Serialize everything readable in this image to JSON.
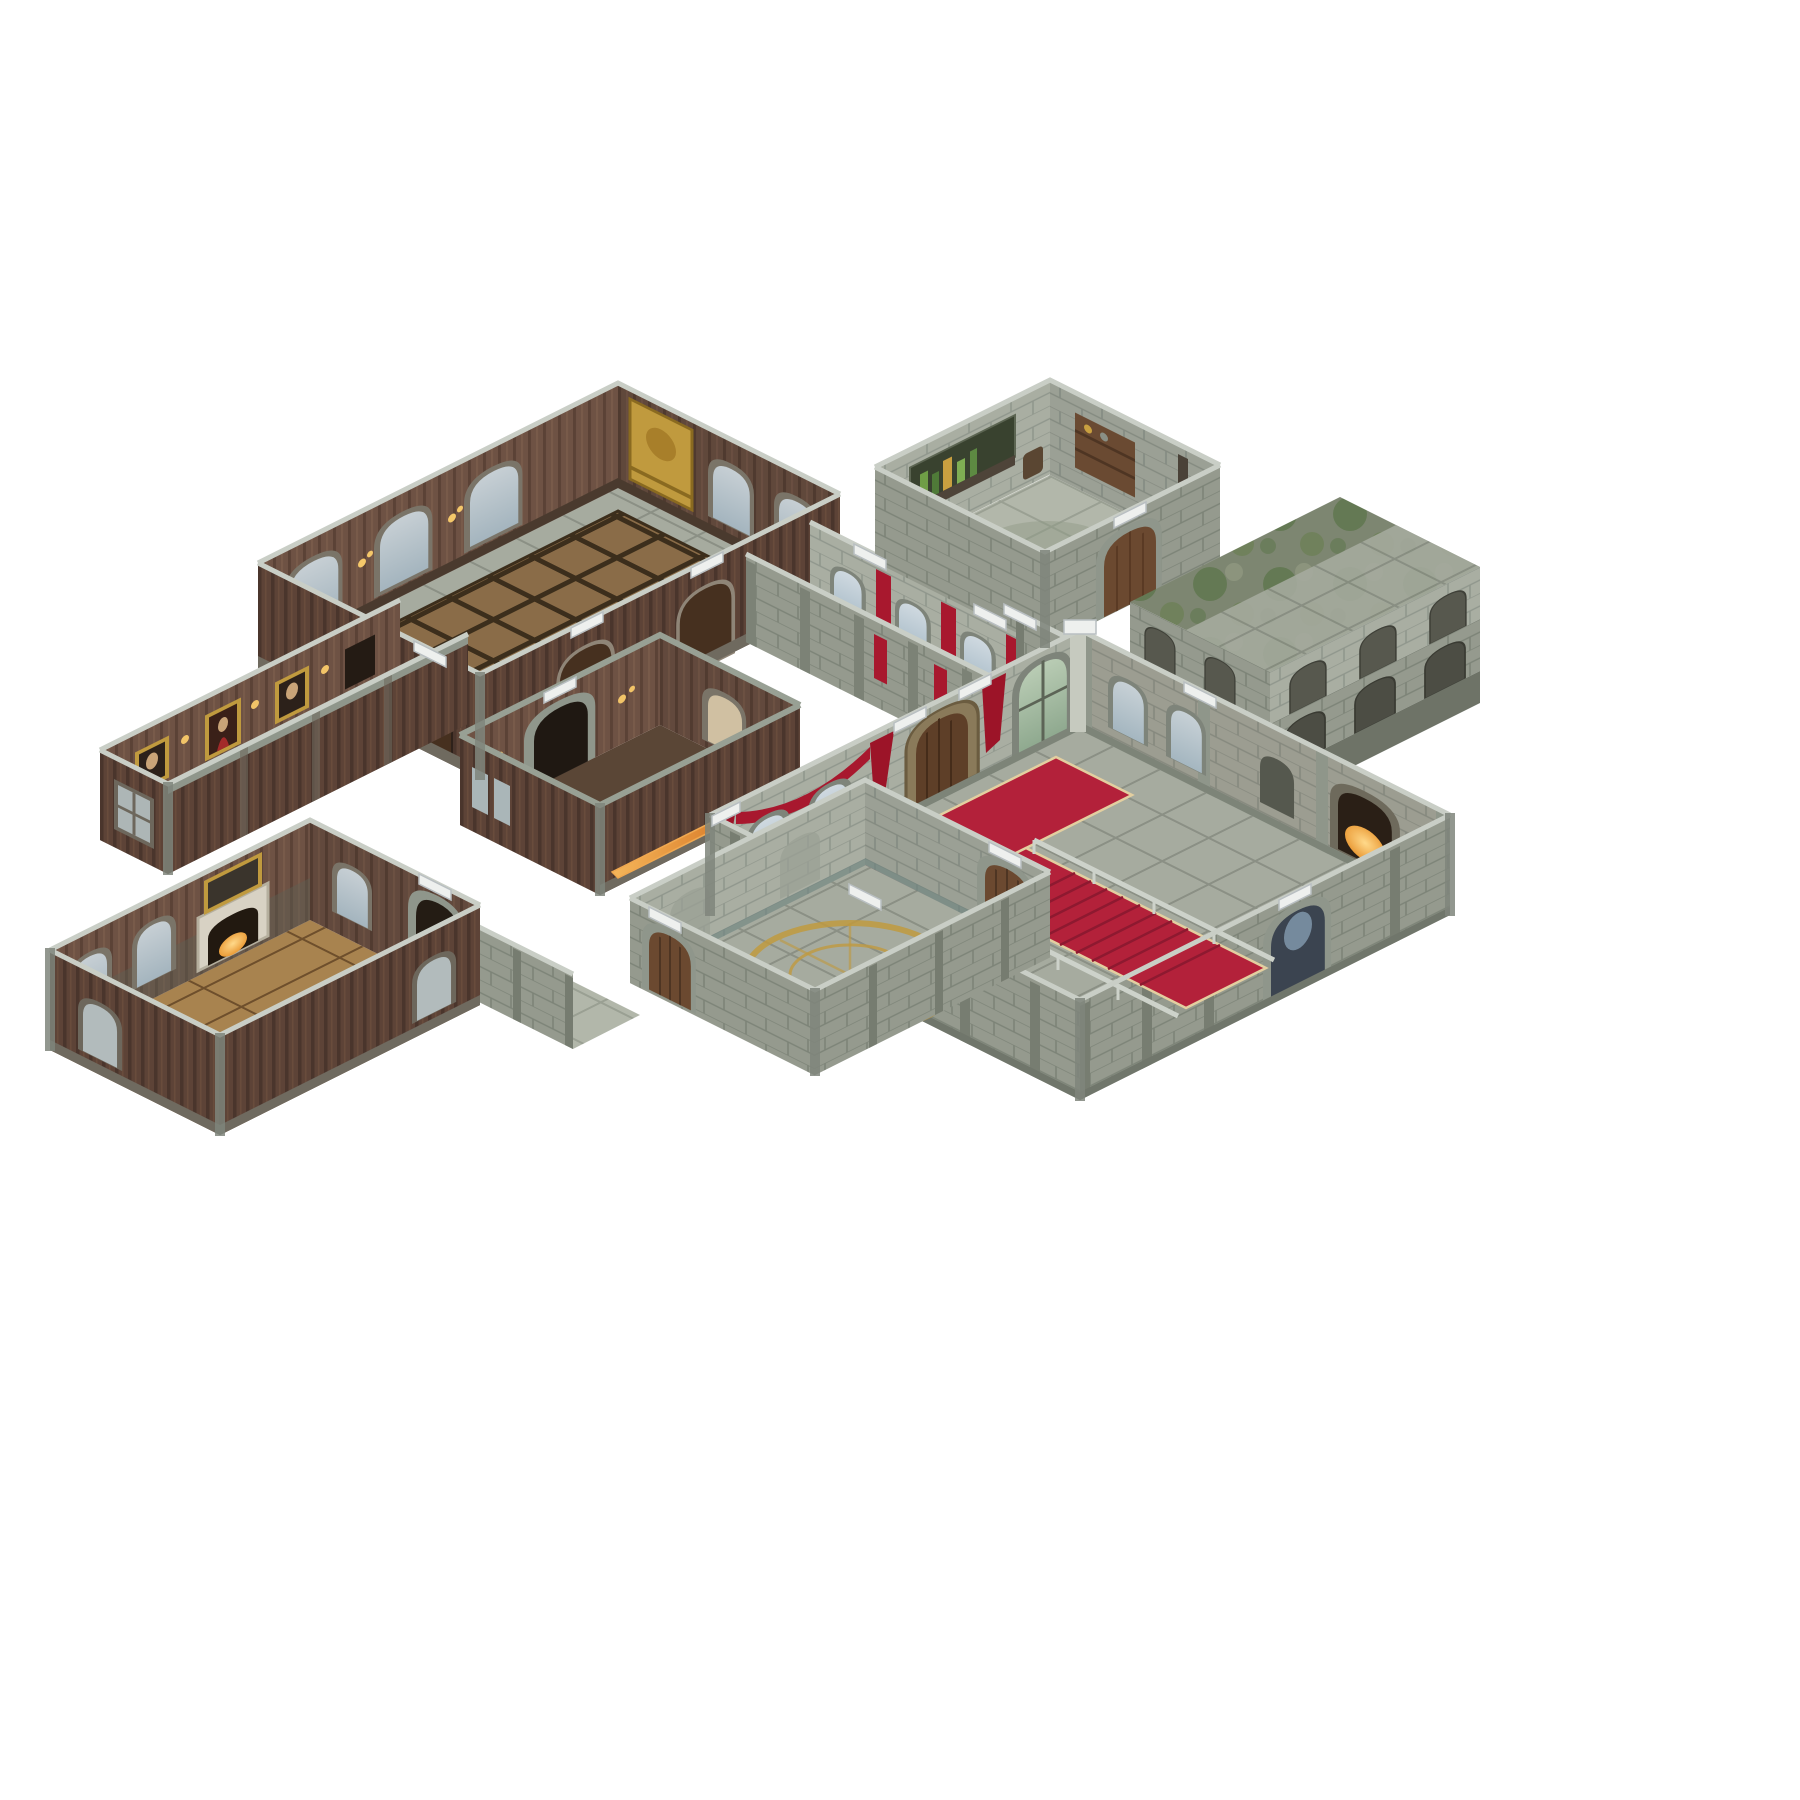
{
  "image": {
    "kind": "product-photo",
    "subject": "Isometric modular tabletop dungeon terrain set with ten connected castle rooms and corridors on a white background",
    "background": "#ffffff"
  },
  "palette": {
    "bg": "#ffffff",
    "wood_int": "#6e5244",
    "wood_int_line": "#5b4236",
    "wood_int_hi": "#7d5f4e",
    "wood_ext": "#5d4337",
    "wood_ext_line": "#4a352c",
    "wood_ext_hi": "#6a4c3d",
    "wood_skirt": "#4a3a2e",
    "stone_wall": "#a9aea2",
    "stone_wall_line": "#8f968c",
    "stone_wall_dark": "#959a8e",
    "stone_wall_dark_line": "#7c8377",
    "stone_floor": "#a6ab9f",
    "stone_floor_line": "#848a7e",
    "stone_floor_pale": "#b2b7aa",
    "stone_floor_pale_line": "#939a8d",
    "hall_floor": "#8a6c48",
    "hall_floor_line": "#3c2e1c",
    "plank_floor": "#a8834f",
    "plank_floor_line": "#6e4f2c",
    "moss_base": "#7d8671",
    "moss_dark": "#5a7347",
    "moss_mid": "#6d8056",
    "moss_light": "#8e967f",
    "carpet": "#b3213a",
    "carpet_dark": "#8e1930",
    "carpet_edge": "#e3cfa0",
    "curtain": "#9c1428",
    "banner": "#a8182e",
    "gold": "#c09a3e",
    "gold_dark": "#8a6a20",
    "glass_blue_1": "#cfd9e0",
    "glass_blue_2": "#a9bcc8",
    "glass_green_1": "#b9ccb4",
    "glass_green_2": "#8fa98f",
    "door_brown": "#6b4930",
    "door_brown_dark": "#46301f",
    "frame_stone": "#8f968b",
    "cap_white": "#eef0ee",
    "cap_line": "#b9bfc2",
    "fire_1": "#ffd98a",
    "fire_2": "#e8952f",
    "rail": "#cdd2ca",
    "mosaic": "#a8874e",
    "post": "#7f857b",
    "top_edge": "#c9cec6",
    "trim_teal": "#6e8480"
  },
  "pieces": [
    {
      "id": "great-hall",
      "label": "Great hall with arched windows, gold tapestry and diamond parquet floor"
    },
    {
      "id": "portrait-gallery",
      "label": "Panelled gallery corridor with framed portraits and candle sconces"
    },
    {
      "id": "antechamber",
      "label": "Wood-panelled antechamber with stone doorway and glowing ember trough"
    },
    {
      "id": "storeroom",
      "label": "Stone storeroom with shelves of bottles, rack and barrel"
    },
    {
      "id": "north-corridor",
      "label": "Stone corridor with arched windows and red banners"
    },
    {
      "id": "kitchen-landing",
      "label": "Stepped stone landing outside the storeroom door"
    },
    {
      "id": "courtyard-tiles",
      "label": "Mossy ruined courtyard tiles with carved arch reliefs"
    },
    {
      "id": "grand-entrance",
      "label": "Grand entrance hall with T-shaped red carpet, carpeted staircase, railings, red curtains and fireplace"
    },
    {
      "id": "west-corridor",
      "label": "Flagstone corridor linking study and ritual chamber"
    },
    {
      "id": "ritual-chamber",
      "label": "Low stone chamber with gold ceremonial circle inlaid in the floor"
    },
    {
      "id": "study",
      "label": "Study with fireplace, mirror, arched windows and plank floor"
    }
  ]
}
